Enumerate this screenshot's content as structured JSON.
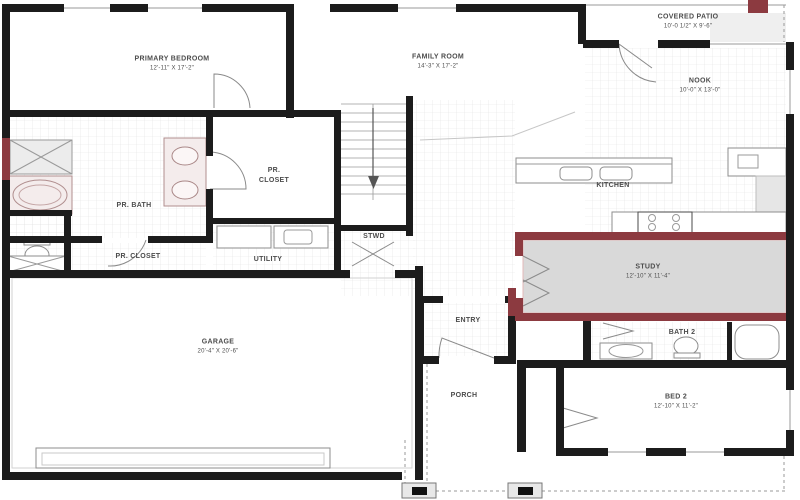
{
  "title": "Floor Plan - First Floor",
  "colors": {
    "wall": "#1c1c1c",
    "accent": "#8c3a40",
    "option_fill": "#d9d9d9",
    "grid_line": "#e2e2e2",
    "label_text": "#4c4c4c"
  },
  "rooms": {
    "primary_bedroom": {
      "label": "PRIMARY BEDROOM",
      "dims": "12'-11\" X 17'-2\""
    },
    "family_room": {
      "label": "FAMILY ROOM",
      "dims": "14'-3\" X 17'-2\""
    },
    "covered_patio": {
      "label": "COVERED PATIO",
      "dims": "10'-0 1/2\" X 9'-6\""
    },
    "nook": {
      "label": "NOOK",
      "dims": "10'-0\" X 13'-0\""
    },
    "kitchen": {
      "label": "KITCHEN",
      "dims": ""
    },
    "study": {
      "label": "STUDY",
      "dims": "12'-10\" X 11'-4\""
    },
    "pr_bath": {
      "label": "PR. BATH",
      "dims": ""
    },
    "pr_closet_front": {
      "label": "PR. CLOSET",
      "dims": ""
    },
    "pr_closet_main": {
      "label": "PR. CLOSET",
      "dims": ""
    },
    "utility": {
      "label": "UTILITY",
      "dims": ""
    },
    "stwd": {
      "label": "STWD",
      "dims": ""
    },
    "entry": {
      "label": "ENTRY",
      "dims": ""
    },
    "porch": {
      "label": "PORCH",
      "dims": ""
    },
    "garage": {
      "label": "GARAGE",
      "dims": "20'-4\" X 20'-6\""
    },
    "bath_2": {
      "label": "BATH 2",
      "dims": ""
    },
    "bed_2": {
      "label": "BED 2",
      "dims": "12'-10\" X 11'-2\""
    }
  }
}
